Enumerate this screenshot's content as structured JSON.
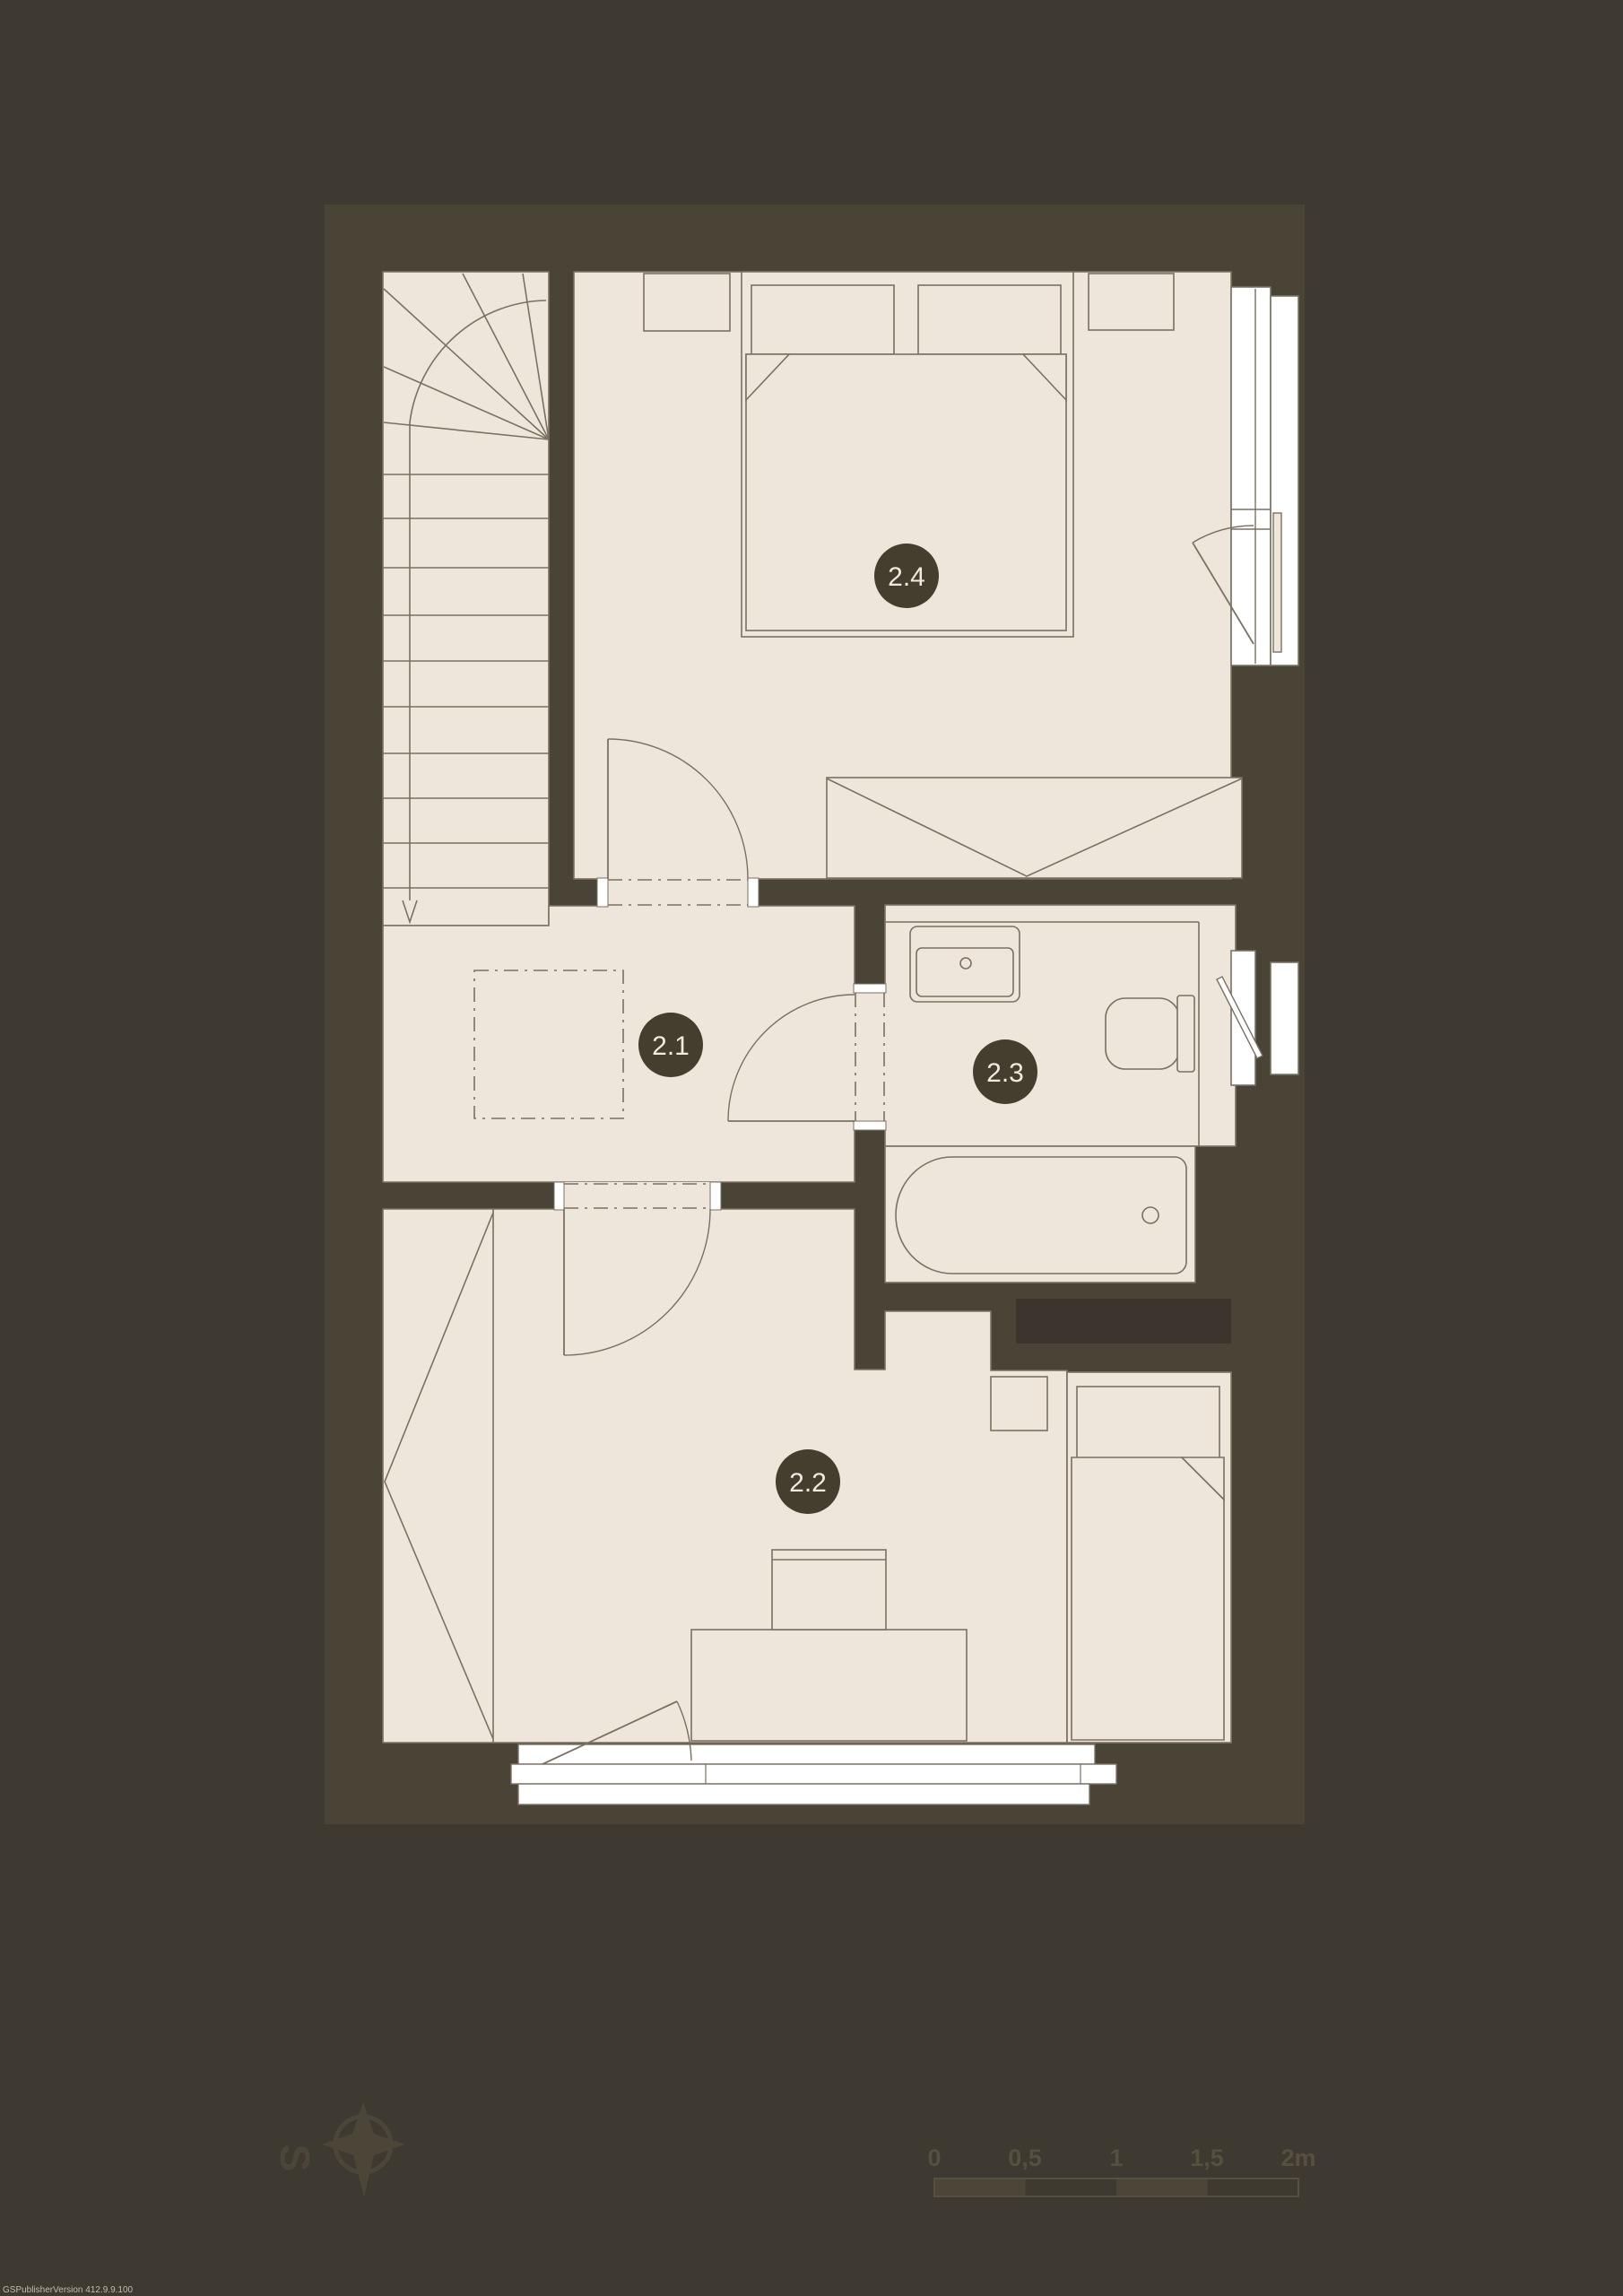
{
  "plan": {
    "floor_rooms": [
      {
        "id": "2.1"
      },
      {
        "id": "2.2"
      },
      {
        "id": "2.3"
      },
      {
        "id": "2.4"
      }
    ]
  },
  "legend": {
    "scale_ticks": [
      "0",
      "0,5",
      "1",
      "1,5",
      "2m"
    ],
    "compass_letter": "S"
  },
  "watermark": "GSPublisherVersion 412.9.9.100",
  "colors": {
    "background": "#3E3931",
    "wall": "#4A4437",
    "room_fill": "#EEE6DA",
    "line": "#7A7163",
    "duct": "#3B352D",
    "label_circle": "#443E2F",
    "label_text": "#F0EBE0",
    "window_white": "#FFFFFF",
    "legend_olive": "#4C4639"
  }
}
